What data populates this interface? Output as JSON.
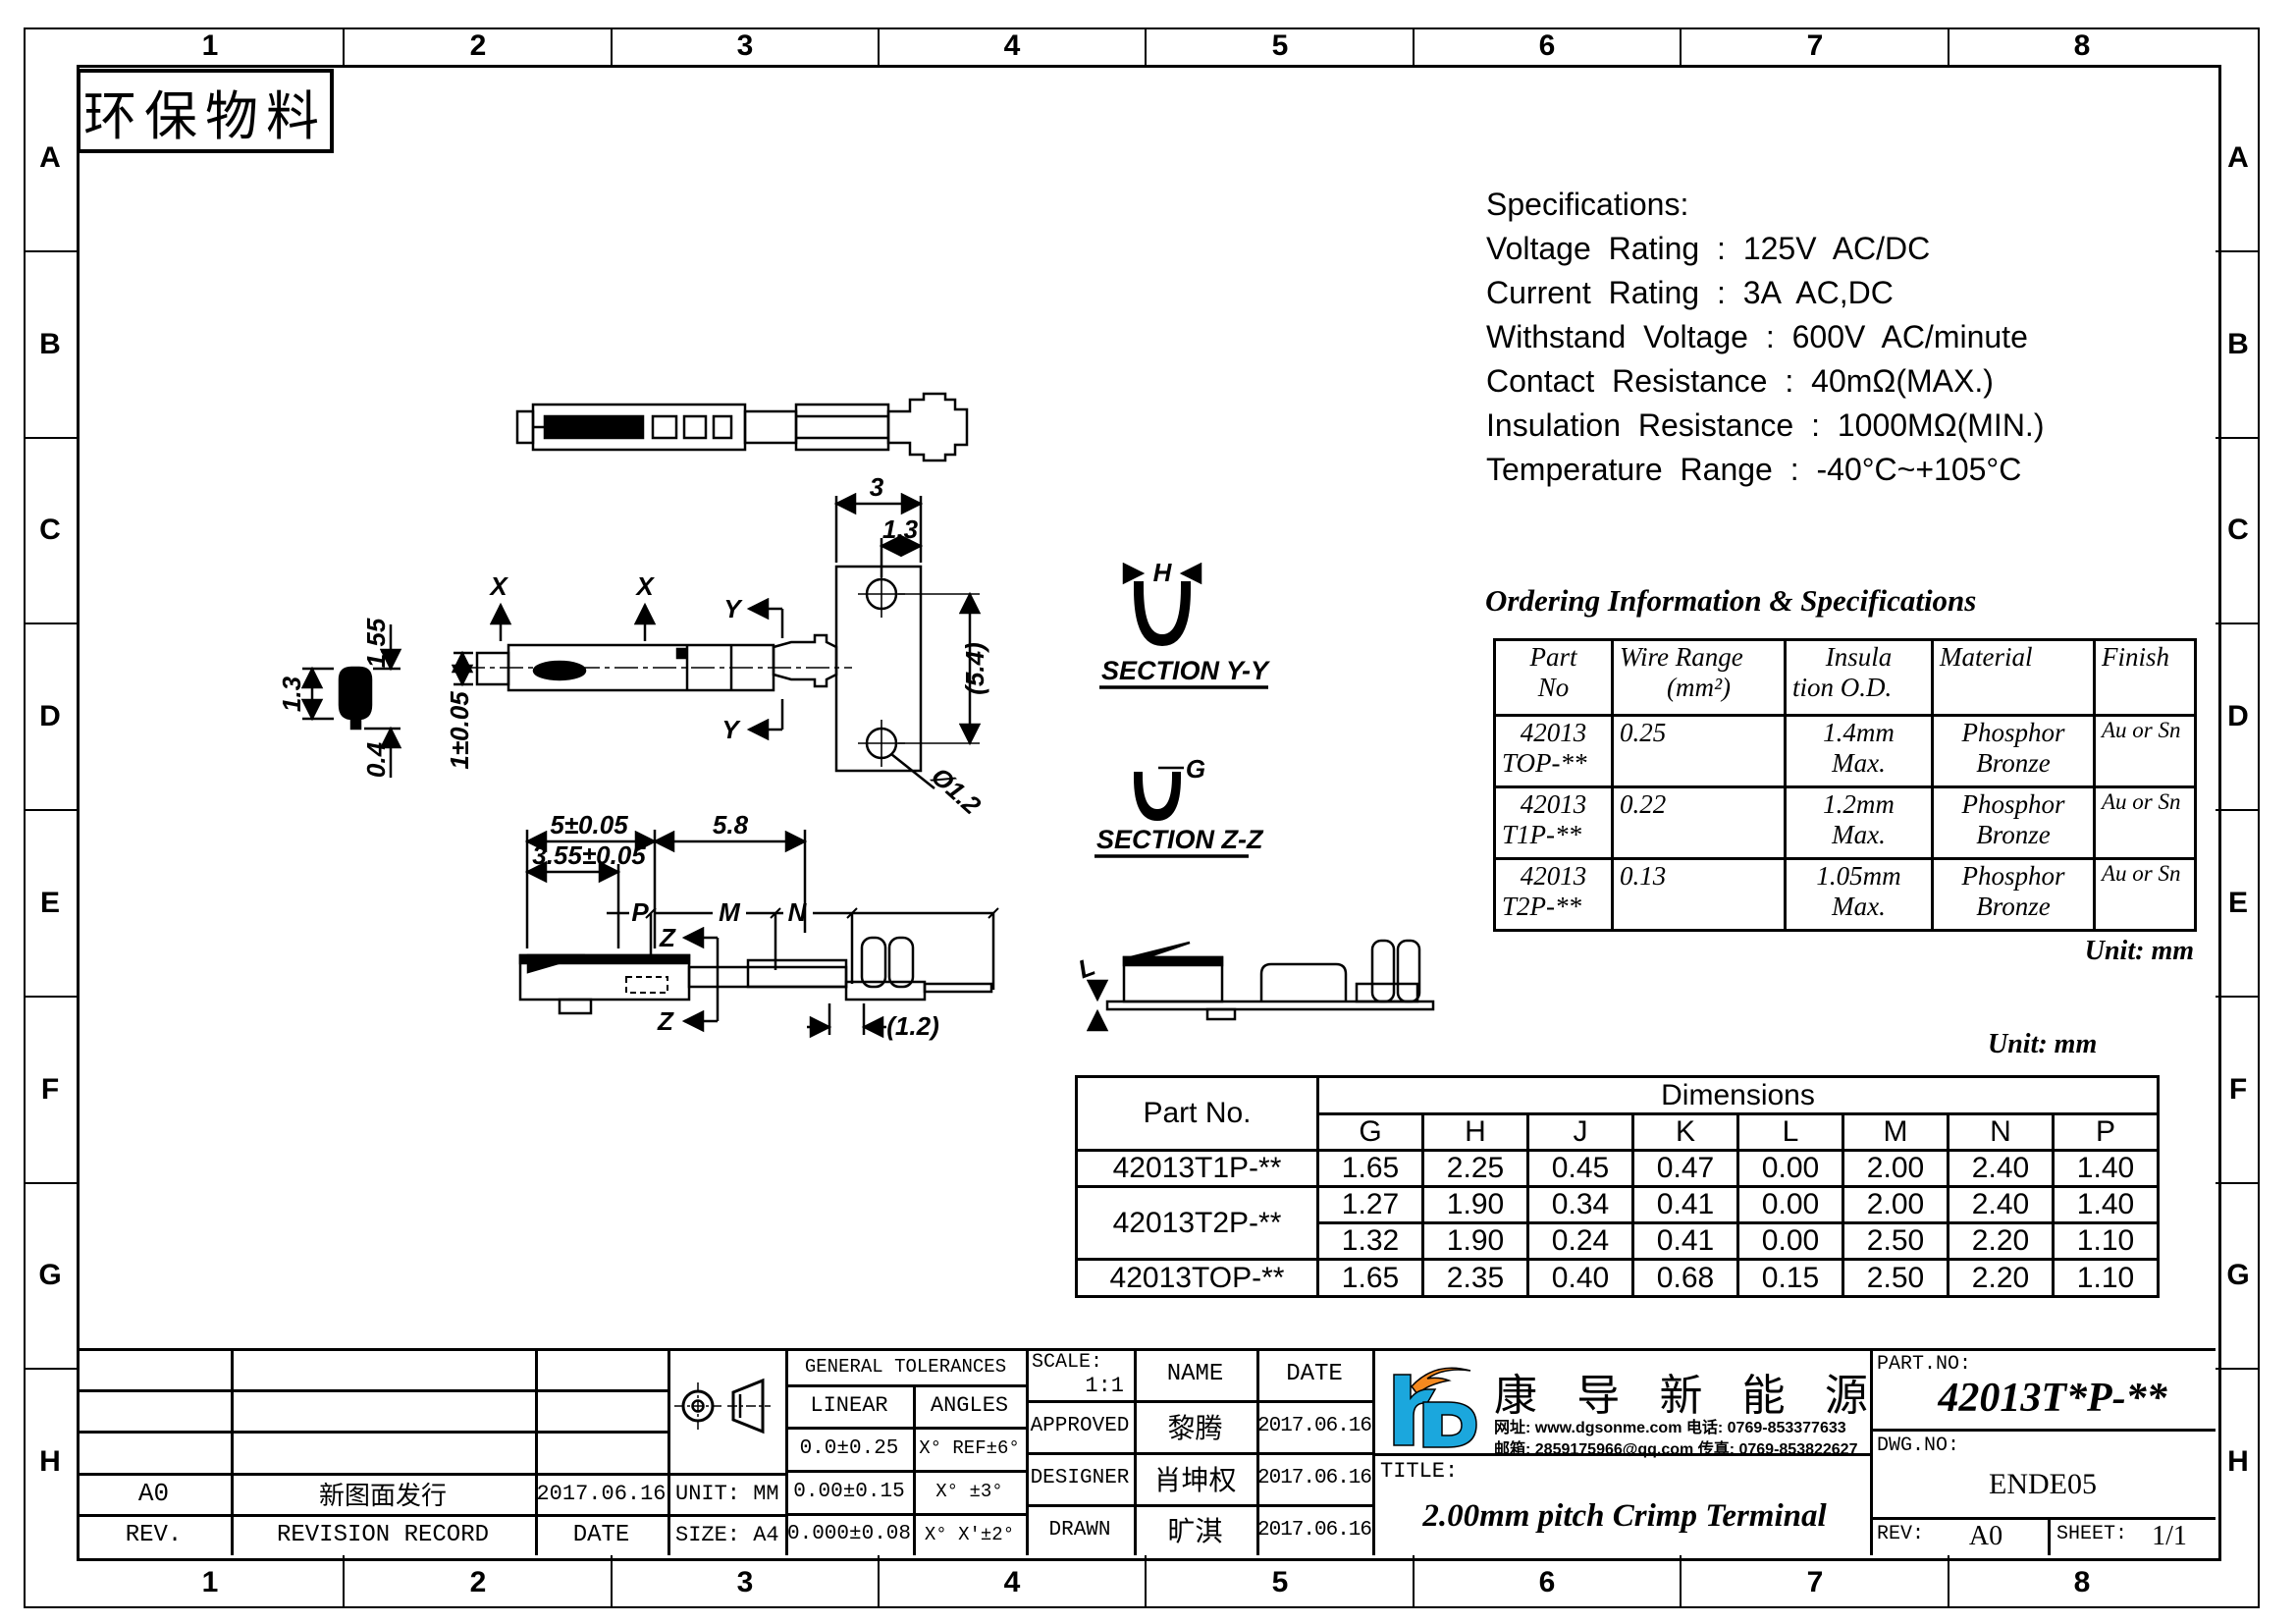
{
  "stamp": "环保物料",
  "border": {
    "columns": [
      "1",
      "2",
      "3",
      "4",
      "5",
      "6",
      "7",
      "8"
    ],
    "rows": [
      "A",
      "B",
      "C",
      "D",
      "E",
      "F",
      "G",
      "H"
    ]
  },
  "specifications": {
    "title": "Specifications:",
    "lines": [
      "Voltage Rating : 125V AC/DC",
      "Current Rating : 3A AC,DC",
      "Withstand Voltage : 600V AC/minute",
      "Contact Resistance : 40mΩ(MAX.)",
      "Insulation Resistance : 1000MΩ(MIN.)",
      "Temperature Range : -40°C~+105°C"
    ]
  },
  "ordering": {
    "title": "Ordering Information & Specifications",
    "headers": {
      "part": [
        "Part",
        "No"
      ],
      "wire": [
        "Wire Range",
        "(mm²)"
      ],
      "insulation": [
        "Insula",
        "tion O.D."
      ],
      "material": "Material",
      "finish": "Finish"
    },
    "rows": [
      {
        "part1": "42013",
        "part2": "TOP-**",
        "wire": "0.25",
        "ins1": "1.4mm",
        "ins2": "Max.",
        "mat1": "Phosphor",
        "mat2": "Bronze",
        "finish": "Au or Sn"
      },
      {
        "part1": "42013",
        "part2": "T1P-**",
        "wire": "0.22",
        "ins1": "1.2mm",
        "ins2": "Max.",
        "mat1": "Phosphor",
        "mat2": "Bronze",
        "finish": "Au or Sn"
      },
      {
        "part1": "42013",
        "part2": "T2P-**",
        "wire": "0.13",
        "ins1": "1.05mm",
        "ins2": "Max.",
        "mat1": "Phosphor",
        "mat2": "Bronze",
        "finish": "Au or Sn"
      }
    ],
    "unit_note": "Unit: mm"
  },
  "dimensions": {
    "unit_note": "Unit: mm",
    "part_header": "Part No.",
    "group_header": "Dimensions",
    "columns": [
      "G",
      "H",
      "J",
      "K",
      "L",
      "M",
      "N",
      "P"
    ],
    "parts": [
      "42013T1P-**",
      "42013T2P-**",
      "42013TOP-**"
    ],
    "value_rows": [
      [
        "1.65",
        "2.25",
        "0.45",
        "0.47",
        "0.00",
        "2.00",
        "2.40",
        "1.40"
      ],
      [
        "1.27",
        "1.90",
        "0.34",
        "0.41",
        "0.00",
        "2.00",
        "2.40",
        "1.40"
      ],
      [
        "1.32",
        "1.90",
        "0.24",
        "0.41",
        "0.00",
        "2.50",
        "2.20",
        "1.10"
      ],
      [
        "1.65",
        "2.35",
        "0.40",
        "0.68",
        "0.15",
        "2.50",
        "2.20",
        "1.10"
      ]
    ]
  },
  "drawing": {
    "front": {
      "d1": "1.3",
      "d2": "1.55",
      "d3": "0.4"
    },
    "side": {
      "x": "X",
      "y": "Y",
      "h": "1±0.05"
    },
    "plate": {
      "w": "3",
      "off": "1.3",
      "pitch": "(5.4)",
      "hole": "Ø1.2"
    },
    "section_yy": {
      "dim": "H",
      "label": "SECTION Y-Y"
    },
    "section_zz": {
      "dim": "G",
      "label": "SECTION Z-Z"
    },
    "bottom": {
      "d1": "5±0.05",
      "d2": "5.8",
      "d3": "3.55±0.05",
      "p": "P",
      "m": "M",
      "n": "N",
      "z": "Z",
      "d4": "(1.2)"
    },
    "profile": {
      "l": "L"
    }
  },
  "titleblock": {
    "revision": {
      "rev_value": "A0",
      "record_value": "新图面发行",
      "date_value": "2017.06.16",
      "rev_label": "REV.",
      "record_label": "REVISION RECORD",
      "date_label": "DATE"
    },
    "unit": "UNIT: MM",
    "size": "SIZE: A4",
    "tolerances": {
      "title": "GENERAL TOLERANCES",
      "linear": "LINEAR",
      "angles": "ANGLES",
      "rows": [
        [
          "0.0±0.25",
          "X° REF±6°"
        ],
        [
          "0.00±0.15",
          "X° ±3°"
        ],
        [
          "0.000±0.08",
          "X° X'±2°"
        ]
      ]
    },
    "scale_label": "SCALE:",
    "scale_value": "1:1",
    "name_label": "NAME",
    "date_label": "DATE",
    "signoff": [
      {
        "role": "APPROVED",
        "name": "黎腾",
        "date": "2017.06.16"
      },
      {
        "role": "DESIGNER",
        "name": "肖坤权",
        "date": "2017.06.16"
      },
      {
        "role": "DRAWN",
        "name": "旷淇",
        "date": "2017.06.16"
      }
    ],
    "company": {
      "name": "康 导 新 能 源",
      "contact1": "网址: www.dgsonme.com  电话: 0769-853377633",
      "contact2": "邮箱: 2859175966@qq.com 传真: 0769-853822627"
    },
    "title_label": "TITLE:",
    "title_value": "2.00mm pitch Crimp Terminal",
    "partno_label": "PART.NO:",
    "partno_value": "42013T*P-**",
    "dwg_label": "DWG.NO:",
    "dwg_value": "ENDE05",
    "rev_label": "REV:",
    "rev_value": "A0",
    "sheet_label": "SHEET:",
    "sheet_value": "1/1"
  },
  "colors": {
    "line": "#000000",
    "logo_blue": "#1BA7DD",
    "logo_orange": "#F6891F"
  }
}
